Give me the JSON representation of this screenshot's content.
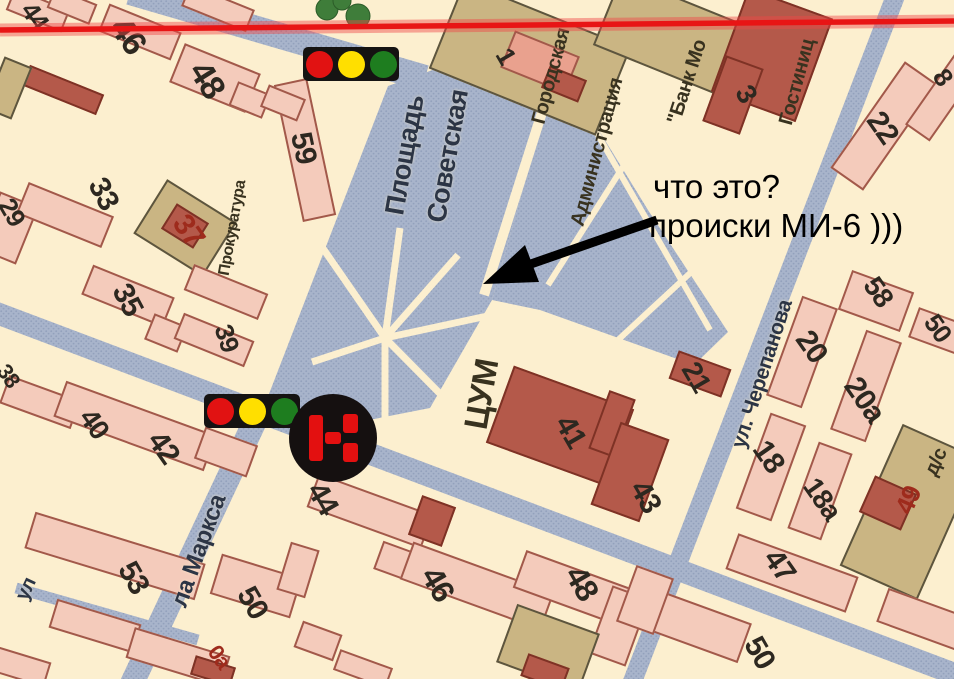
{
  "annotation": {
    "line1": "что это?",
    "line2": "происки МИ-6 )))"
  },
  "palette": {
    "cream": "#fcefcf",
    "street_blue": "#a8b4cb",
    "street_dot": "#93a1bc",
    "building_pink": "#f4cbbb",
    "building_maroon": "#b4594a",
    "building_tan": "#cab583",
    "red_line": "#e81515",
    "arrow_black": "#000000",
    "num": "#2d2820",
    "numred": "#9e2b1c",
    "street": "#2c3545",
    "place": "#38321f"
  },
  "icons": {
    "traffic_light_colors": [
      "#e11212",
      "#ffdf00",
      "#1e7d1f"
    ],
    "badge": {
      "ring": "#151010",
      "glyph_color": "#e31010",
      "name": "road-sign"
    }
  },
  "map": {
    "square_name": "Площадь Советская",
    "labels": [
      {
        "text": "44",
        "x": 35,
        "y": 16,
        "rot": 55,
        "size": 26,
        "kind": "num"
      },
      {
        "text": "46",
        "x": 128,
        "y": 36,
        "rot": 55,
        "size": 34,
        "kind": "num"
      },
      {
        "text": "48",
        "x": 207,
        "y": 80,
        "rot": 58,
        "size": 34,
        "kind": "num"
      },
      {
        "text": "59",
        "x": 303,
        "y": 148,
        "rot": 78,
        "size": 30,
        "kind": "num"
      },
      {
        "text": "29",
        "x": 12,
        "y": 212,
        "rot": 60,
        "size": 26,
        "kind": "num"
      },
      {
        "text": "33",
        "x": 103,
        "y": 194,
        "rot": 62,
        "size": 30,
        "kind": "num"
      },
      {
        "text": "37",
        "x": 188,
        "y": 231,
        "rot": 55,
        "size": 30,
        "kind": "numred"
      },
      {
        "text": "35",
        "x": 127,
        "y": 300,
        "rot": 62,
        "size": 30,
        "kind": "num"
      },
      {
        "text": "39",
        "x": 227,
        "y": 338,
        "rot": 72,
        "size": 26,
        "kind": "num"
      },
      {
        "text": "38",
        "x": 8,
        "y": 376,
        "rot": 55,
        "size": 22,
        "kind": "num"
      },
      {
        "text": "40",
        "x": 94,
        "y": 424,
        "rot": 55,
        "size": 28,
        "kind": "num"
      },
      {
        "text": "42",
        "x": 163,
        "y": 448,
        "rot": 55,
        "size": 30,
        "kind": "num"
      },
      {
        "text": "44",
        "x": 322,
        "y": 499,
        "rot": 60,
        "size": 30,
        "kind": "num"
      },
      {
        "text": "53",
        "x": 133,
        "y": 578,
        "rot": 60,
        "size": 30,
        "kind": "num"
      },
      {
        "text": "50",
        "x": 252,
        "y": 603,
        "rot": 60,
        "size": 30,
        "kind": "num"
      },
      {
        "text": "46",
        "x": 438,
        "y": 584,
        "rot": 60,
        "size": 32,
        "kind": "num"
      },
      {
        "text": "48",
        "x": 582,
        "y": 583,
        "rot": 60,
        "size": 32,
        "kind": "num"
      },
      {
        "text": "41",
        "x": 570,
        "y": 432,
        "rot": 60,
        "size": 30,
        "kind": "num"
      },
      {
        "text": "43",
        "x": 645,
        "y": 497,
        "rot": 60,
        "size": 30,
        "kind": "num"
      },
      {
        "text": "21",
        "x": 696,
        "y": 377,
        "rot": 60,
        "size": 28,
        "kind": "num"
      },
      {
        "text": "20",
        "x": 811,
        "y": 347,
        "rot": 55,
        "size": 30,
        "kind": "num"
      },
      {
        "text": "20а",
        "x": 864,
        "y": 400,
        "rot": 55,
        "size": 30,
        "kind": "num"
      },
      {
        "text": "58",
        "x": 878,
        "y": 292,
        "rot": 55,
        "size": 28,
        "kind": "num"
      },
      {
        "text": "50",
        "x": 938,
        "y": 328,
        "rot": 55,
        "size": 26,
        "kind": "num"
      },
      {
        "text": "8",
        "x": 943,
        "y": 77,
        "rot": 55,
        "size": 26,
        "kind": "num"
      },
      {
        "text": "18",
        "x": 768,
        "y": 457,
        "rot": 55,
        "size": 30,
        "kind": "num"
      },
      {
        "text": "18а",
        "x": 822,
        "y": 499,
        "rot": 55,
        "size": 28,
        "kind": "num"
      },
      {
        "text": "47",
        "x": 779,
        "y": 566,
        "rot": 55,
        "size": 30,
        "kind": "num"
      },
      {
        "text": "49",
        "x": 908,
        "y": 500,
        "rot": -66,
        "size": 26,
        "kind": "numred"
      },
      {
        "text": "50",
        "x": 759,
        "y": 653,
        "rot": 60,
        "size": 30,
        "kind": "num"
      },
      {
        "text": "0а",
        "x": 219,
        "y": 657,
        "rot": 55,
        "size": 22,
        "kind": "numred"
      },
      {
        "text": "3",
        "x": 746,
        "y": 94,
        "rot": 60,
        "size": 28,
        "kind": "num"
      },
      {
        "text": "1",
        "x": 506,
        "y": 56,
        "rot": 60,
        "size": 26,
        "kind": "num"
      },
      {
        "text": "22",
        "x": 882,
        "y": 128,
        "rot": 55,
        "size": 30,
        "kind": "num"
      },
      {
        "text": "Площадь",
        "x": 405,
        "y": 155,
        "rot": -80,
        "size": 27,
        "kind": "street"
      },
      {
        "text": "Советская",
        "x": 448,
        "y": 156,
        "rot": -80,
        "size": 27,
        "kind": "street"
      },
      {
        "text": "ул. Черепанова",
        "x": 762,
        "y": 374,
        "rot": -72,
        "size": 21,
        "kind": "street"
      },
      {
        "text": "ла Маркса",
        "x": 199,
        "y": 551,
        "rot": -70,
        "size": 24,
        "kind": "street"
      },
      {
        "text": "ул",
        "x": 26,
        "y": 589,
        "rot": -65,
        "size": 20,
        "kind": "street"
      },
      {
        "text": "ЦУМ",
        "x": 481,
        "y": 394,
        "rot": -80,
        "size": 33,
        "kind": "place"
      },
      {
        "text": "Прокуратура",
        "x": 233,
        "y": 228,
        "rot": -80,
        "size": 16,
        "kind": "place"
      },
      {
        "text": "Городская",
        "x": 551,
        "y": 76,
        "rot": -75,
        "size": 20,
        "kind": "place"
      },
      {
        "text": "Администрация",
        "x": 597,
        "y": 152,
        "rot": -75,
        "size": 20,
        "kind": "place"
      },
      {
        "text": "\"Банк Мо",
        "x": 687,
        "y": 82,
        "rot": -72,
        "size": 20,
        "kind": "place"
      },
      {
        "text": "Гостиниц",
        "x": 797,
        "y": 82,
        "rot": -75,
        "size": 20,
        "kind": "place"
      },
      {
        "text": "д/с",
        "x": 936,
        "y": 462,
        "rot": -66,
        "size": 20,
        "kind": "place"
      }
    ],
    "buildings": [
      {
        "x": 38,
        "y": 10,
        "w": 60,
        "h": 24,
        "rot": 22,
        "type": "pink"
      },
      {
        "x": 72,
        "y": 6,
        "w": 46,
        "h": 22,
        "rot": 22,
        "type": "pink"
      },
      {
        "x": 218,
        "y": 8,
        "w": 70,
        "h": 24,
        "rot": 22,
        "type": "pink"
      },
      {
        "x": 140,
        "y": 32,
        "w": 78,
        "h": 30,
        "rot": 22,
        "type": "pink"
      },
      {
        "x": 215,
        "y": 78,
        "w": 82,
        "h": 42,
        "rot": 22,
        "type": "pink"
      },
      {
        "x": 250,
        "y": 100,
        "w": 36,
        "h": 26,
        "rot": 22,
        "type": "pink"
      },
      {
        "x": 305,
        "y": 150,
        "w": 34,
        "h": 140,
        "rot": -12,
        "type": "pink"
      },
      {
        "x": 283,
        "y": 103,
        "w": 40,
        "h": 24,
        "rot": 22,
        "type": "pink"
      },
      {
        "x": 63,
        "y": 90,
        "w": 80,
        "h": 22,
        "rot": 22,
        "type": "maroon"
      },
      {
        "x": 8,
        "y": 88,
        "w": 30,
        "h": 56,
        "rot": 22,
        "type": "tan"
      },
      {
        "x": 8,
        "y": 228,
        "w": 42,
        "h": 62,
        "rot": 22,
        "type": "pink"
      },
      {
        "x": 65,
        "y": 215,
        "w": 92,
        "h": 34,
        "rot": 22,
        "type": "pink"
      },
      {
        "x": 185,
        "y": 228,
        "w": 82,
        "h": 64,
        "rot": 32,
        "type": "tan"
      },
      {
        "x": 185,
        "y": 226,
        "w": 38,
        "h": 30,
        "rot": 32,
        "type": "maroon"
      },
      {
        "x": 128,
        "y": 296,
        "w": 88,
        "h": 32,
        "rot": 22,
        "type": "pink"
      },
      {
        "x": 166,
        "y": 333,
        "w": 36,
        "h": 28,
        "rot": 22,
        "type": "pink"
      },
      {
        "x": 226,
        "y": 292,
        "w": 80,
        "h": 28,
        "rot": 22,
        "type": "pink"
      },
      {
        "x": 214,
        "y": 340,
        "w": 76,
        "h": 28,
        "rot": 22,
        "type": "pink"
      },
      {
        "x": 40,
        "y": 402,
        "w": 76,
        "h": 30,
        "rot": 20,
        "type": "pink"
      },
      {
        "x": 135,
        "y": 426,
        "w": 160,
        "h": 38,
        "rot": 20,
        "type": "pink"
      },
      {
        "x": 226,
        "y": 452,
        "w": 56,
        "h": 34,
        "rot": 20,
        "type": "pink"
      },
      {
        "x": 370,
        "y": 511,
        "w": 122,
        "h": 36,
        "rot": 20,
        "type": "pink"
      },
      {
        "x": 432,
        "y": 521,
        "w": 36,
        "h": 42,
        "rot": 20,
        "type": "maroon"
      },
      {
        "x": 398,
        "y": 562,
        "w": 42,
        "h": 30,
        "rot": 20,
        "type": "pink"
      },
      {
        "x": 477,
        "y": 586,
        "w": 150,
        "h": 40,
        "rot": 20,
        "type": "pink"
      },
      {
        "x": 575,
        "y": 589,
        "w": 118,
        "h": 40,
        "rot": 20,
        "type": "pink"
      },
      {
        "x": 619,
        "y": 626,
        "w": 40,
        "h": 72,
        "rot": 20,
        "type": "pink"
      },
      {
        "x": 548,
        "y": 648,
        "w": 88,
        "h": 62,
        "rot": 20,
        "type": "tan"
      },
      {
        "x": 545,
        "y": 672,
        "w": 44,
        "h": 24,
        "rot": 20,
        "type": "maroon"
      },
      {
        "x": 560,
        "y": 426,
        "w": 128,
        "h": 82,
        "rot": 20,
        "type": "maroon"
      },
      {
        "x": 612,
        "y": 424,
        "w": 28,
        "h": 62,
        "rot": 20,
        "type": "maroon"
      },
      {
        "x": 630,
        "y": 472,
        "w": 52,
        "h": 88,
        "rot": 20,
        "type": "maroon"
      },
      {
        "x": 700,
        "y": 374,
        "w": 56,
        "h": 30,
        "rot": 20,
        "type": "maroon"
      },
      {
        "x": 530,
        "y": 58,
        "w": 180,
        "h": 95,
        "rot": 22,
        "type": "tan"
      },
      {
        "x": 540,
        "y": 62,
        "w": 70,
        "h": 40,
        "rot": 22,
        "type": "salmon"
      },
      {
        "x": 564,
        "y": 84,
        "w": 40,
        "h": 24,
        "rot": 22,
        "type": "maroon"
      },
      {
        "x": 672,
        "y": 36,
        "w": 140,
        "h": 76,
        "rot": 22,
        "type": "tan"
      },
      {
        "x": 772,
        "y": 55,
        "w": 90,
        "h": 110,
        "rot": 20,
        "type": "maroon"
      },
      {
        "x": 733,
        "y": 95,
        "w": 40,
        "h": 70,
        "rot": 20,
        "type": "maroon"
      },
      {
        "x": 884,
        "y": 126,
        "w": 40,
        "h": 130,
        "rot": 35,
        "type": "pink"
      },
      {
        "x": 946,
        "y": 92,
        "w": 30,
        "h": 100,
        "rot": 35,
        "type": "pink"
      },
      {
        "x": 876,
        "y": 301,
        "w": 66,
        "h": 42,
        "rot": 20,
        "type": "pink"
      },
      {
        "x": 938,
        "y": 331,
        "w": 52,
        "h": 32,
        "rot": 20,
        "type": "pink"
      },
      {
        "x": 802,
        "y": 352,
        "w": 38,
        "h": 106,
        "rot": 20,
        "type": "pink"
      },
      {
        "x": 866,
        "y": 386,
        "w": 38,
        "h": 106,
        "rot": 20,
        "type": "pink"
      },
      {
        "x": 771,
        "y": 467,
        "w": 38,
        "h": 102,
        "rot": 20,
        "type": "pink"
      },
      {
        "x": 820,
        "y": 491,
        "w": 36,
        "h": 92,
        "rot": 20,
        "type": "pink"
      },
      {
        "x": 910,
        "y": 512,
        "w": 85,
        "h": 155,
        "rot": 24,
        "type": "tan"
      },
      {
        "x": 888,
        "y": 503,
        "w": 46,
        "h": 40,
        "rot": 24,
        "type": "maroon"
      },
      {
        "x": 792,
        "y": 573,
        "w": 128,
        "h": 38,
        "rot": 20,
        "type": "pink"
      },
      {
        "x": 927,
        "y": 621,
        "w": 95,
        "h": 36,
        "rot": 20,
        "type": "pink"
      },
      {
        "x": 686,
        "y": 622,
        "w": 125,
        "h": 42,
        "rot": 20,
        "type": "pink"
      },
      {
        "x": 645,
        "y": 600,
        "w": 40,
        "h": 60,
        "rot": 20,
        "type": "pink"
      },
      {
        "x": 115,
        "y": 556,
        "w": 178,
        "h": 38,
        "rot": 17,
        "type": "pink"
      },
      {
        "x": 256,
        "y": 586,
        "w": 84,
        "h": 42,
        "rot": 17,
        "type": "pink"
      },
      {
        "x": 298,
        "y": 570,
        "w": 30,
        "h": 50,
        "rot": 17,
        "type": "pink"
      },
      {
        "x": 95,
        "y": 626,
        "w": 88,
        "h": 30,
        "rot": 17,
        "type": "pink"
      },
      {
        "x": 178,
        "y": 657,
        "w": 100,
        "h": 32,
        "rot": 17,
        "type": "pink"
      },
      {
        "x": 18,
        "y": 666,
        "w": 62,
        "h": 26,
        "rot": 17,
        "type": "pink"
      },
      {
        "x": 213,
        "y": 671,
        "w": 42,
        "h": 20,
        "rot": 17,
        "type": "maroon"
      },
      {
        "x": 318,
        "y": 641,
        "w": 42,
        "h": 28,
        "rot": 20,
        "type": "pink"
      },
      {
        "x": 363,
        "y": 669,
        "w": 56,
        "h": 22,
        "rot": 20,
        "type": "pink"
      }
    ]
  }
}
